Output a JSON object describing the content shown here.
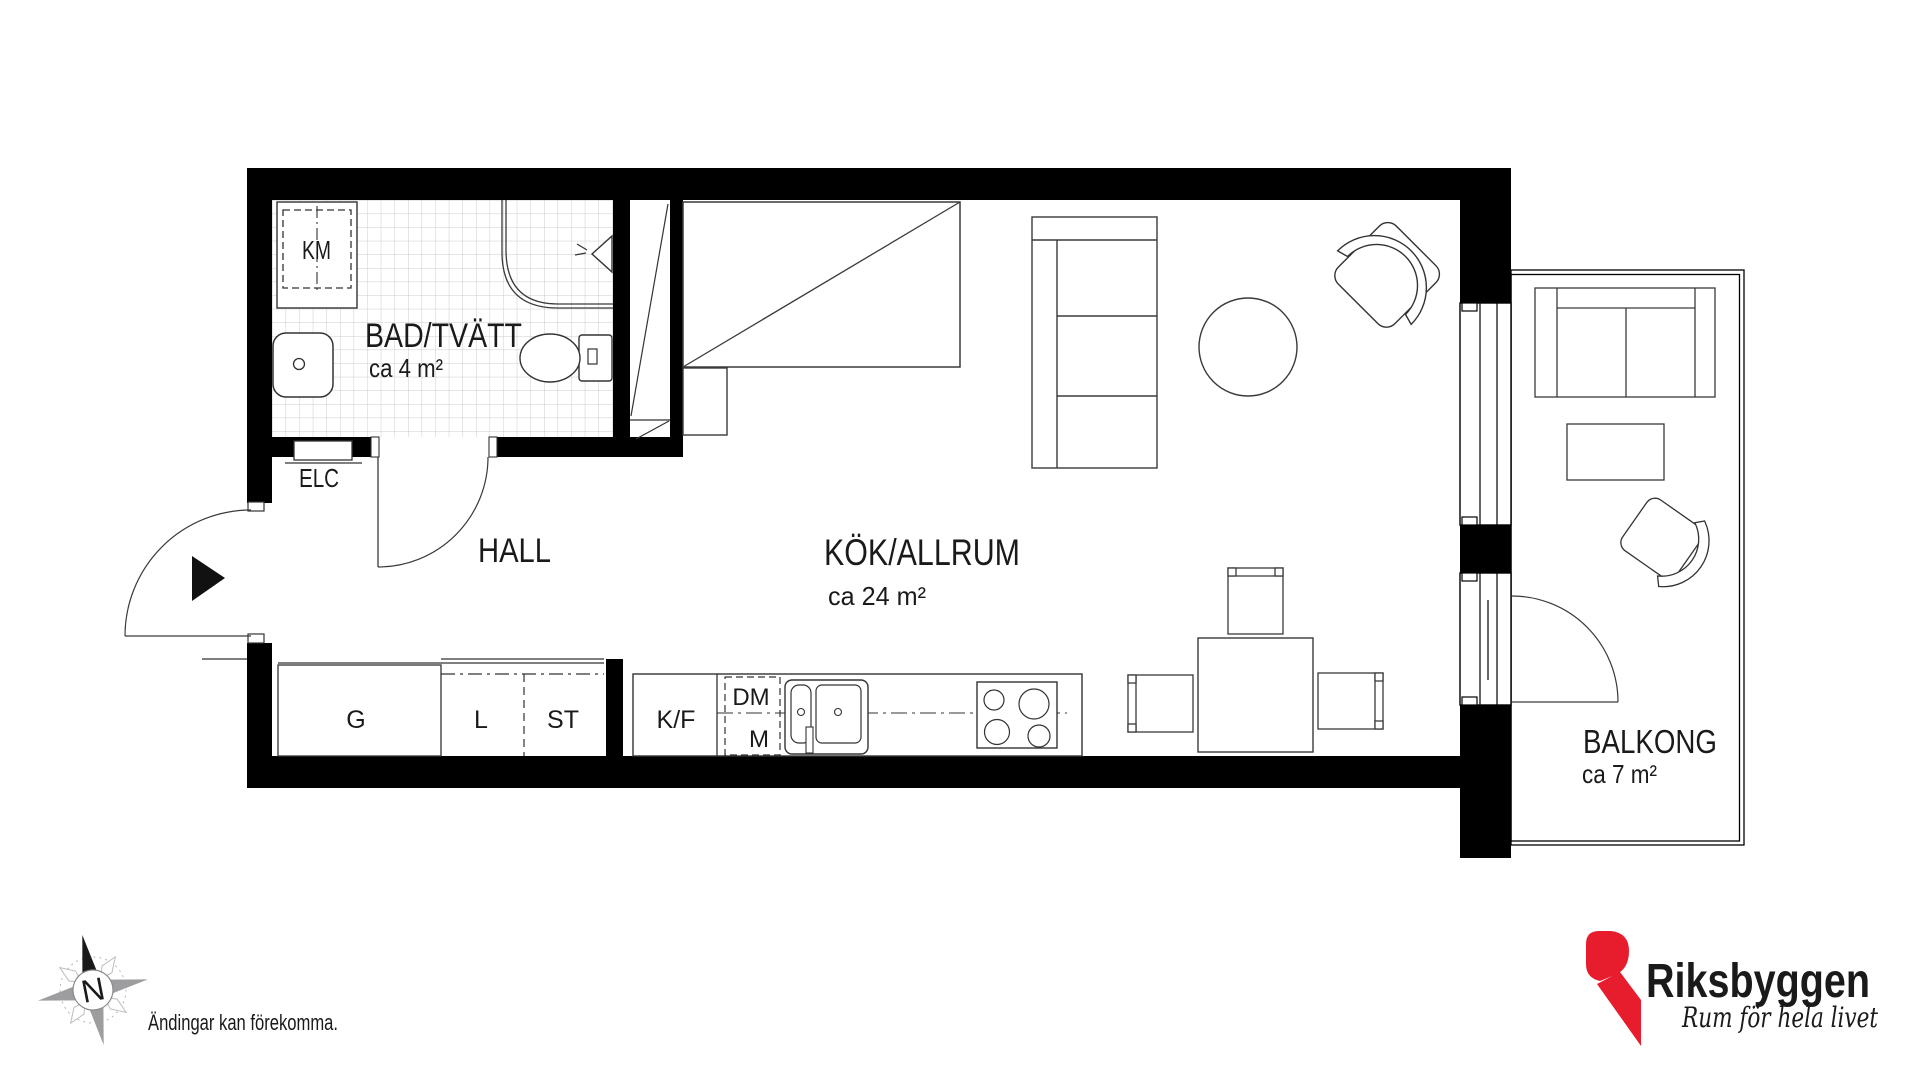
{
  "rooms": {
    "bathroom": {
      "label": "BAD/TVÄTT",
      "area": "ca 4 m²"
    },
    "hall": {
      "label": "HALL"
    },
    "kitchen_living": {
      "label": "KÖK/ALLRUM",
      "area": "ca 24 m²"
    },
    "balcony": {
      "label": "BALKONG",
      "area": "ca 7 m²"
    }
  },
  "fixtures": {
    "washing_machine": "KM",
    "electrical_cabinet": "ELC",
    "wardrobe": "G",
    "linen_cabinet": "L",
    "cleaning_cabinet": "ST",
    "fridge_freezer": "K/F",
    "dishwasher": "DM",
    "micro": "M"
  },
  "compass": {
    "north_label": "N"
  },
  "notes": {
    "disclaimer": "Ändingar kan förekomma."
  },
  "brand": {
    "name": "Riksbyggen",
    "tagline": "Rum för hela livet",
    "red": "#e71d2e",
    "gray": "#9b9b9d"
  }
}
